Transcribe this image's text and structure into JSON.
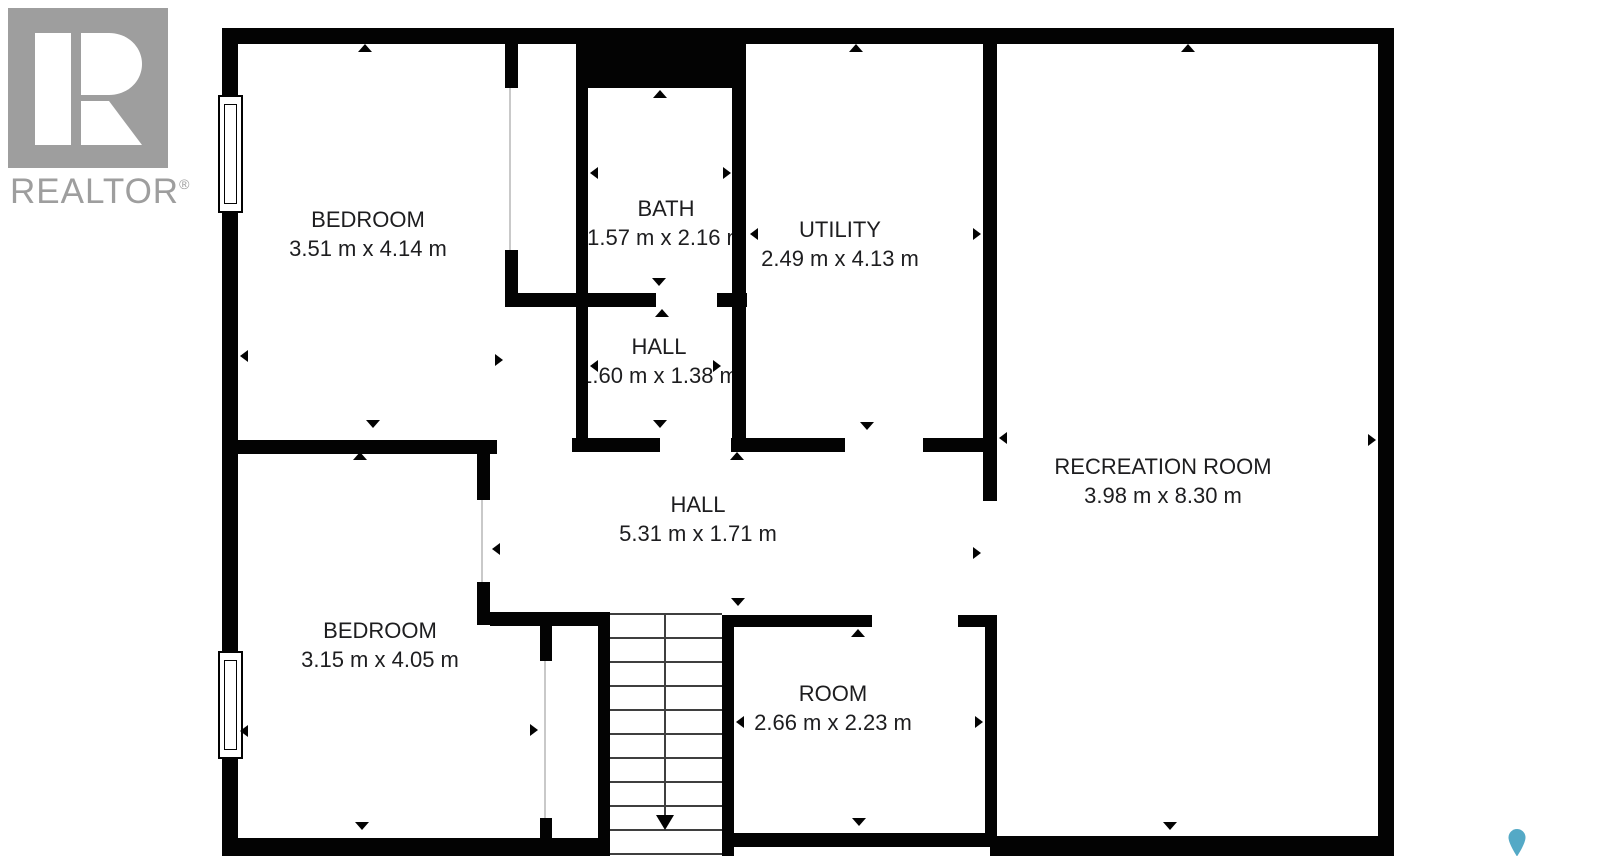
{
  "logo": {
    "word": "REALTOR",
    "registered": "®"
  },
  "rooms": [
    {
      "name": "BEDROOM",
      "dims": "3.51 m x 4.14 m"
    },
    {
      "name": "BATH",
      "dims": "1.57 m x 2.16 m"
    },
    {
      "name": "UTILITY",
      "dims": "2.49 m x 4.13 m"
    },
    {
      "name": "HALL",
      "dims": "1.60 m x 1.38 m"
    },
    {
      "name": "RECREATION ROOM",
      "dims": "3.98 m x 8.30 m"
    },
    {
      "name": "HALL",
      "dims": "5.31 m x 1.71 m"
    },
    {
      "name": "BEDROOM",
      "dims": "3.15 m x 4.05 m"
    },
    {
      "name": "ROOM",
      "dims": "2.66 m x 2.23 m"
    }
  ],
  "colors": {
    "wall": "#030303",
    "text": "#1d1d1f",
    "door": "#c9c9c9",
    "tread": "#3f3f3f",
    "logo": "#9e9e9e",
    "pin": "#54a9c6"
  }
}
